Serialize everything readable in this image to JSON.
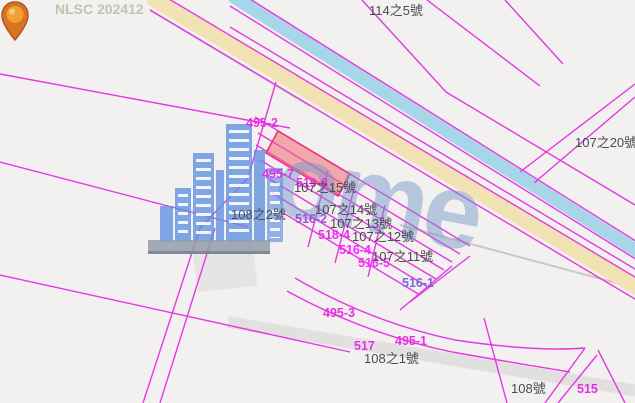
{
  "map": {
    "nlsc_watermark": "NLSC 202412",
    "logo_watermark_text": "ome",
    "logo_watermark_name": "home-buildings-logo"
  },
  "pin": {
    "icon": "location-pin",
    "color_head": "#f0a132",
    "color_body": "#d9731f"
  },
  "colors": {
    "background": "#f2f1ef",
    "parcel_line": "#e438e4",
    "road_fill": "#f1e2b3",
    "canal_fill": "#a8d6e9",
    "highlight_fill": "rgba(242,105,118,0.55)",
    "highlight_stroke": "#e8327c",
    "dark_label": "#4b4b52",
    "magenta_label": "#e531e5",
    "nlsc_green": "#b9c9ad"
  },
  "labels": [
    {
      "text": "NLSC 202412",
      "color": "#b9c9ad",
      "type": "map-source-watermark"
    },
    {
      "text": "114之5號",
      "color": "#4b4b52",
      "type": "address"
    },
    {
      "text": "107之20號",
      "color": "#4b4b52",
      "type": "address"
    },
    {
      "text": "495-2",
      "color": "#e531e5",
      "type": "parcel-number"
    },
    {
      "text": "495-7",
      "color": "#e531e5",
      "type": "parcel-number"
    },
    {
      "text": "519-8",
      "color": "#e531e5",
      "type": "parcel-number"
    },
    {
      "text": "107之15號",
      "color": "#4b4b52",
      "type": "address"
    },
    {
      "text": "107之14號",
      "color": "#4b4b52",
      "type": "address"
    },
    {
      "text": "108之2號",
      "color": "#4b4b52",
      "type": "address"
    },
    {
      "text": "516-2",
      "color": "#a050d8",
      "type": "parcel-number"
    },
    {
      "text": "107之13號",
      "color": "#4b4b52",
      "type": "address"
    },
    {
      "text": "518-4",
      "color": "#e531e5",
      "type": "parcel-number"
    },
    {
      "text": "107之12號",
      "color": "#4b4b52",
      "type": "address"
    },
    {
      "text": "516-4",
      "color": "#ff1fff",
      "type": "parcel-number"
    },
    {
      "text": "516-5",
      "color": "#f036f0",
      "type": "parcel-number"
    },
    {
      "text": "107之11號",
      "color": "#4b4b52",
      "type": "address"
    },
    {
      "text": "516-1",
      "color": "#7b68d8",
      "type": "parcel-number"
    },
    {
      "text": "495-3",
      "color": "#e531e5",
      "type": "parcel-number"
    },
    {
      "text": "495-1",
      "color": "#e531e5",
      "type": "parcel-number"
    },
    {
      "text": "517",
      "color": "#e531e5",
      "type": "parcel-number"
    },
    {
      "text": "108之1號",
      "color": "#4b4b52",
      "type": "address"
    },
    {
      "text": "108號",
      "color": "#4b4b52",
      "type": "address"
    },
    {
      "text": "515",
      "color": "#e531e5",
      "type": "parcel-number"
    }
  ]
}
